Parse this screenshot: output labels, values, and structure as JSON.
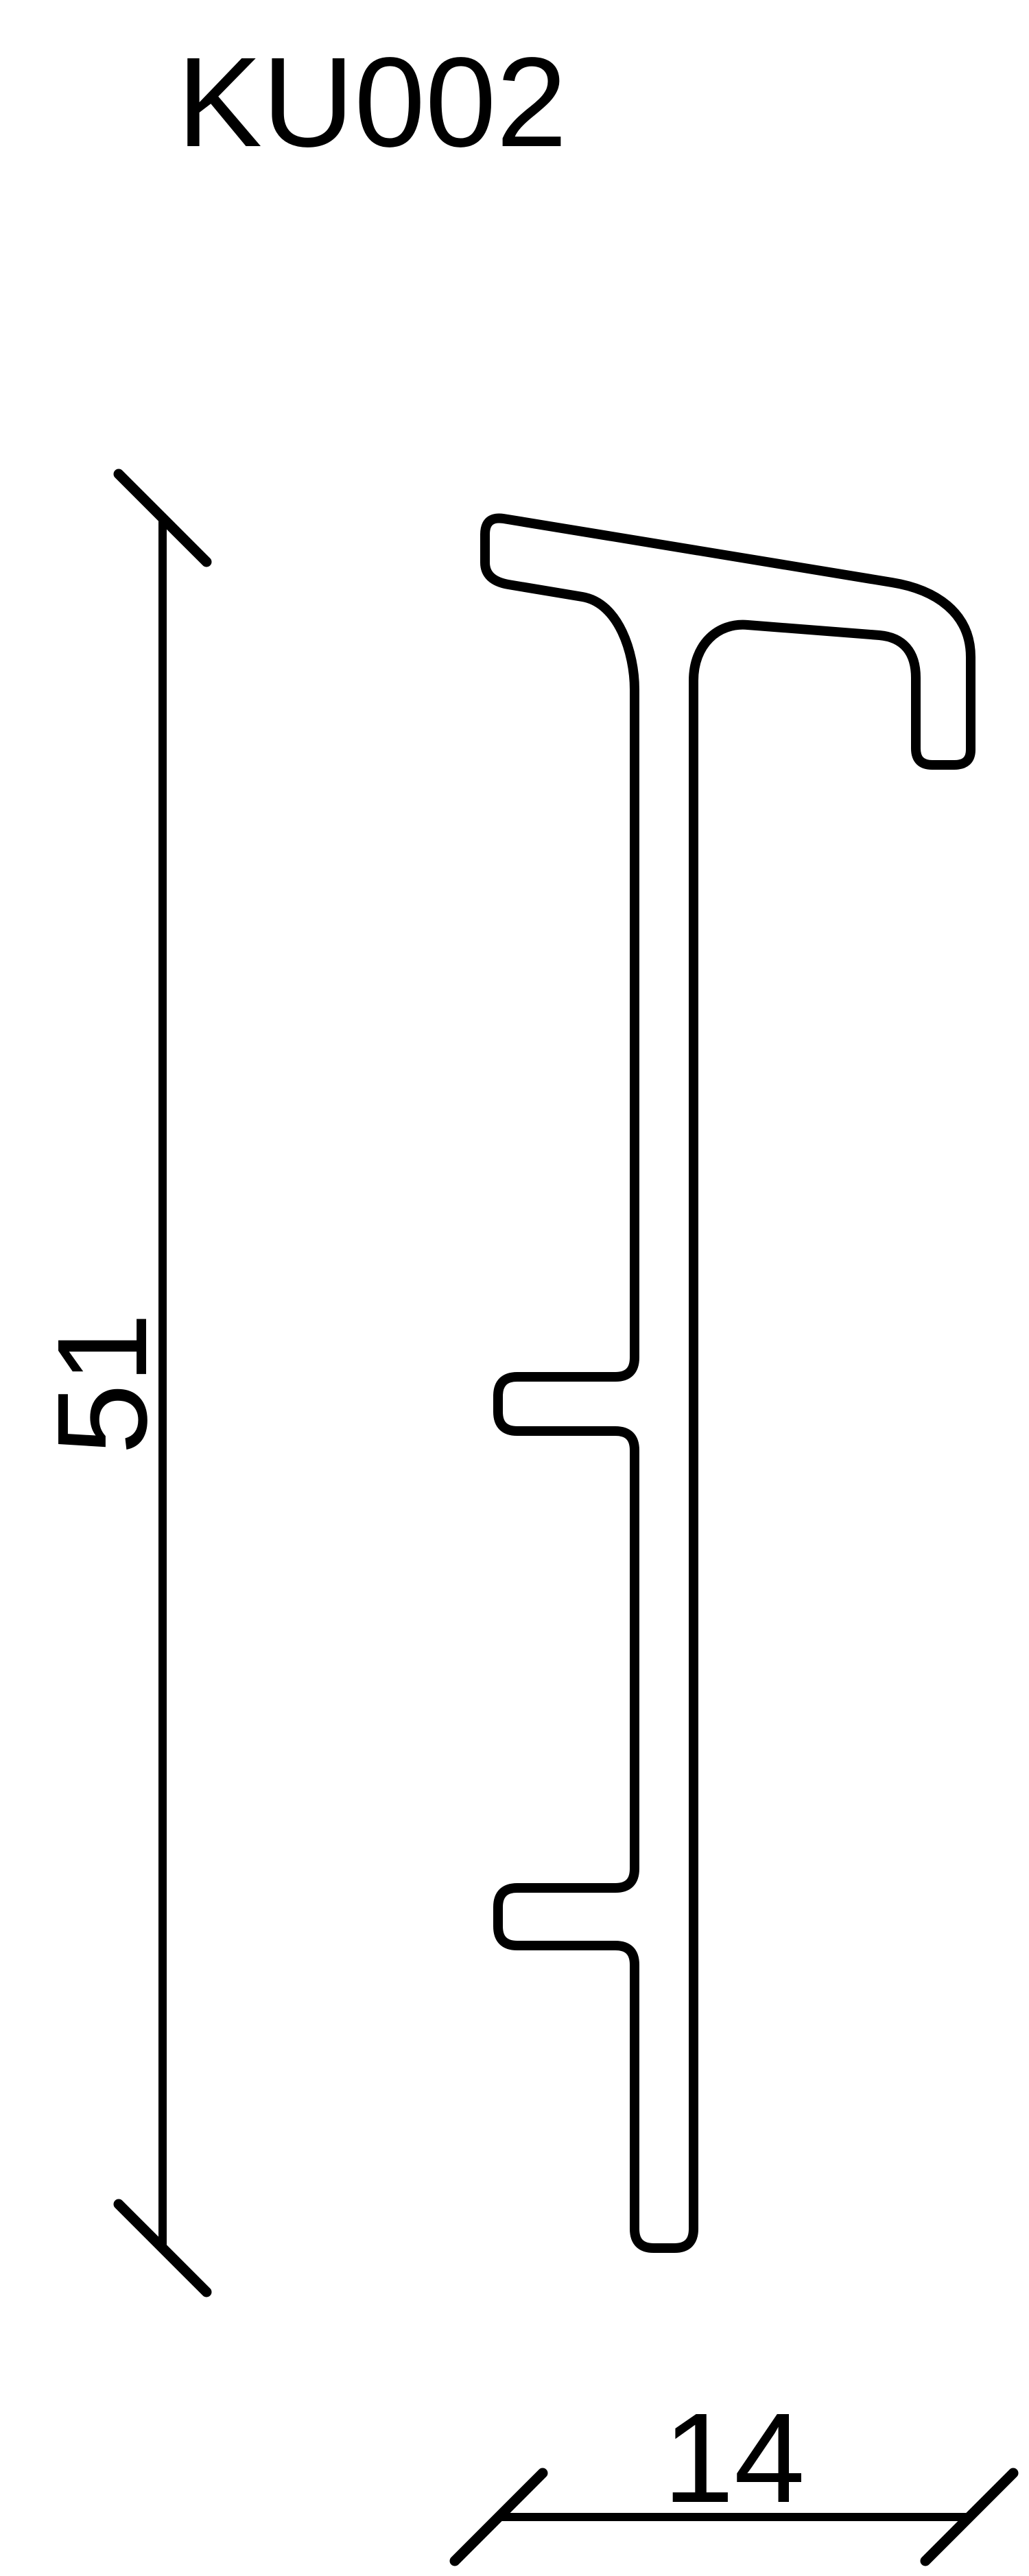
{
  "title": "KU002",
  "colors": {
    "ink": "#000000",
    "background": "#ffffff"
  },
  "profile_drawing": {
    "height_dimension": {
      "value": "51"
    },
    "width_dimension": {
      "value": "14"
    }
  }
}
